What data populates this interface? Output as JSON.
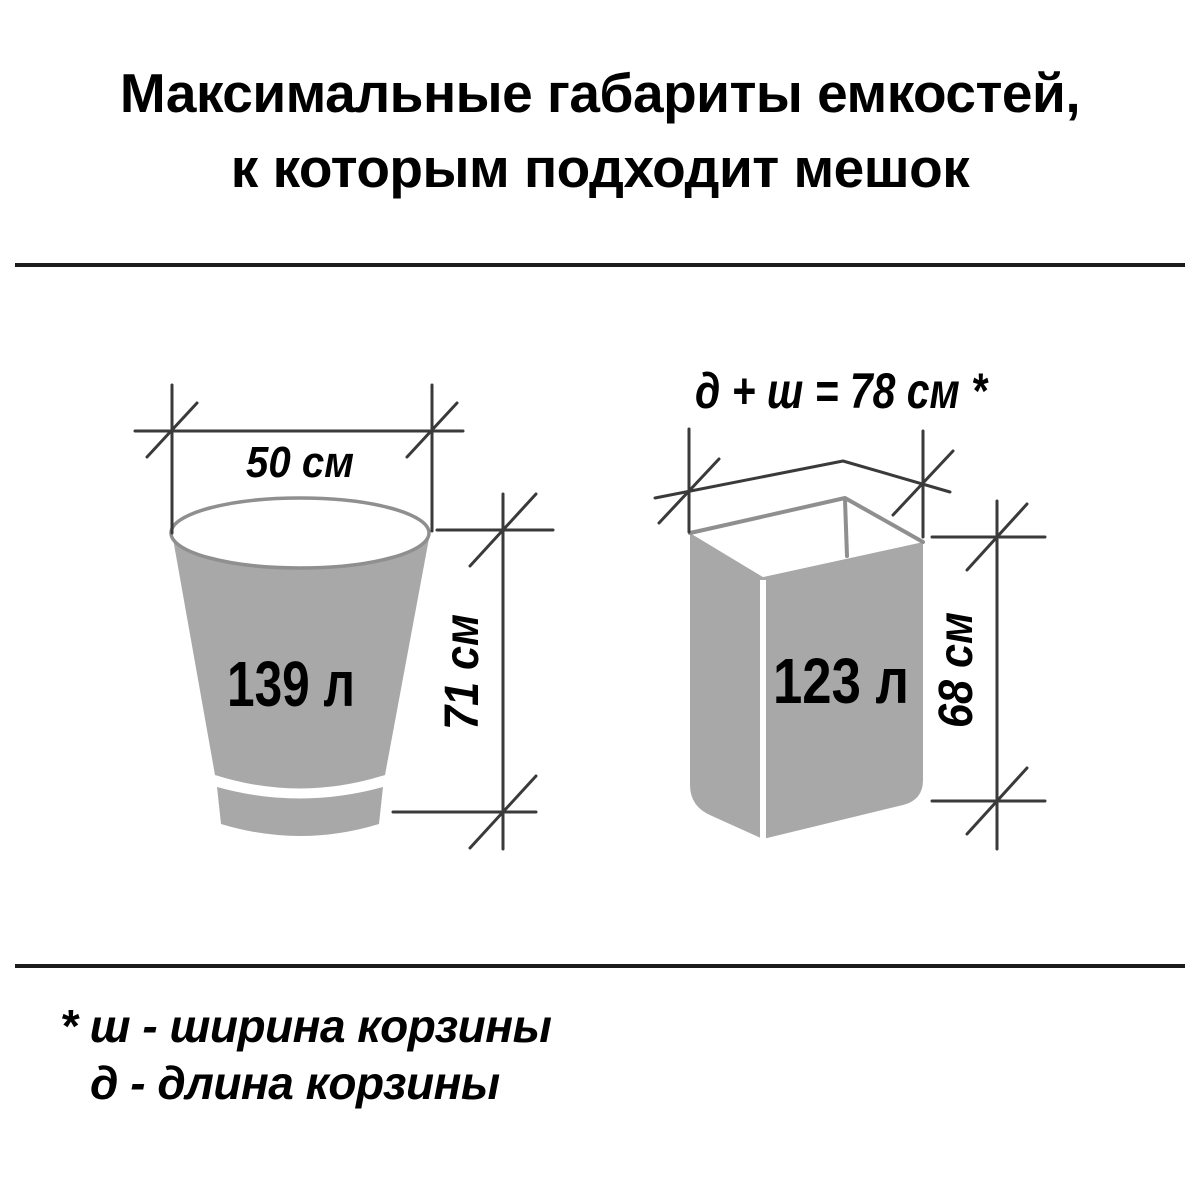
{
  "title": {
    "line1": "Максимальные габариты емкостей,",
    "line2": "к которым подходит мешок"
  },
  "diagrams": {
    "bucket": {
      "volume_label": "139 л",
      "width_label": "50 см",
      "height_label": "71 см"
    },
    "box": {
      "volume_label": "123 л",
      "top_label": "д + ш = 78 см *",
      "height_label": "68 см"
    }
  },
  "footnote": {
    "line1": "* ш - ширина корзины",
    "line2": "д - длина корзины"
  },
  "colors": {
    "background": "#ffffff",
    "container_fill": "#a8a8a8",
    "outline": "#8f8f8f",
    "dimension_line": "#3a3a3a",
    "text": "#000000",
    "divider": "#1c1c1c"
  }
}
